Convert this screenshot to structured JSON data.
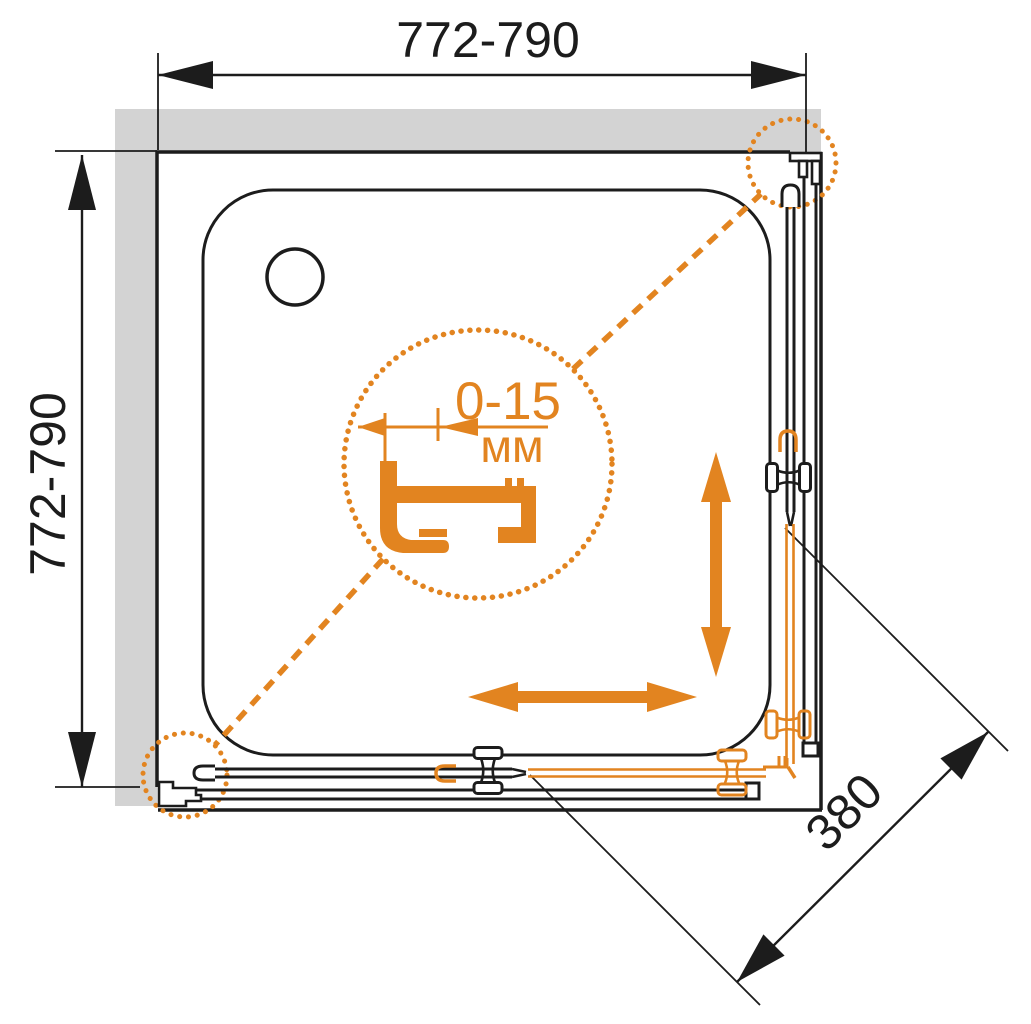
{
  "diagram": {
    "description": "Corner shower enclosure plan view with sliding doors",
    "dimensions": {
      "width_label": "772-790",
      "depth_label": "772-790",
      "entry_label": "380"
    },
    "detail": {
      "value": "0-15",
      "unit": "мм"
    }
  },
  "colors": {
    "accent-orange": "#E28420",
    "wall-gray": "#D3D3D3",
    "line-black": "#1C1C1C"
  }
}
